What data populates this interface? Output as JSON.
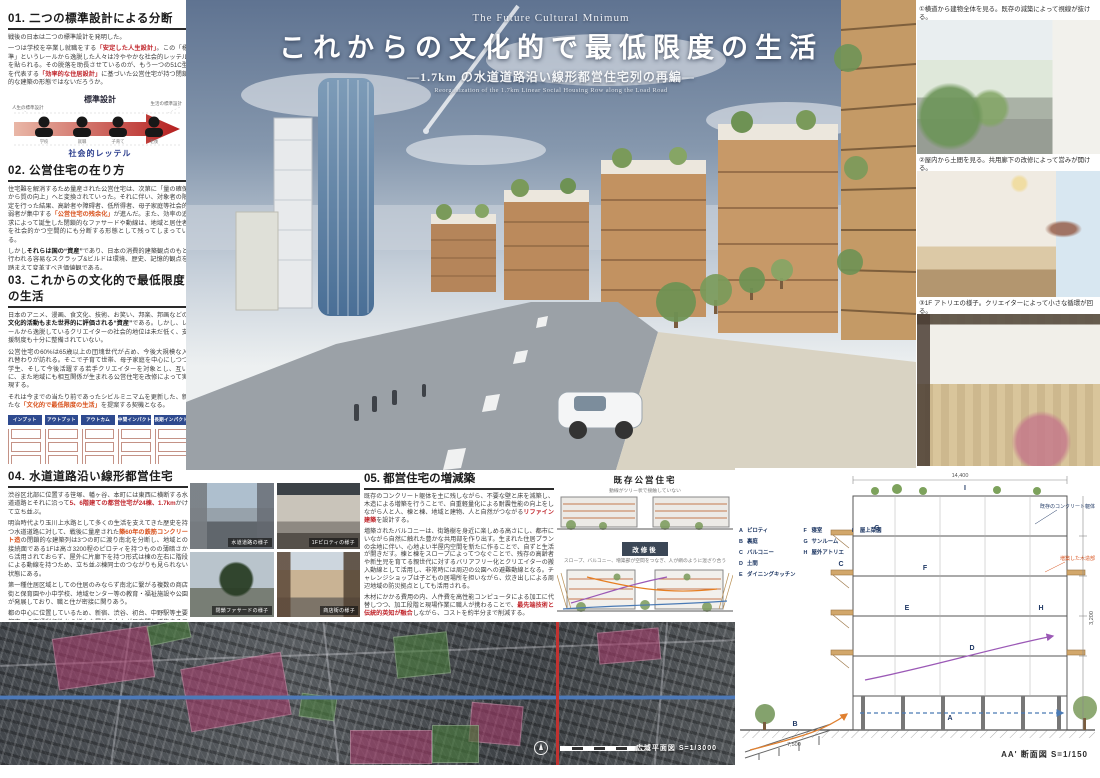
{
  "colors": {
    "accent_red": "#c1272d",
    "accent_orange": "#d9531e",
    "chip_blue": "#2e4a8f",
    "letter_navy": "#1f3864"
  },
  "sections": {
    "s1": {
      "title": "01. 二つの標準設計による分断",
      "p": [
        [
          {
            "t": "戦後の日本は二つの標準設計を発明した。"
          }
        ],
        [
          {
            "t": "一つは学校を卒業し就職をする"
          },
          {
            "t": "「安定した人生設計」",
            "c": "hl-r"
          },
          {
            "t": "。この「標準」というレールから逸脱した人々は冷ややかな社会的レッテルを貼られる。その脱落を助長させているのが、もう一つの51C型を代表する"
          },
          {
            "t": "「効率的な住居設計」",
            "c": "hl-r"
          },
          {
            "t": "に基づいた公営住宅が持つ閉鎖的な建築の形態ではないだろうか。"
          }
        ]
      ]
    },
    "s2": {
      "title": "02. 公営住宅の在り方",
      "p": [
        [
          {
            "t": "住宅難を解消するため量産された公営住宅は、次第に「量の確保から質の向上」へと変換されていった。それに伴い、対象者の限定を行った結果、高齢者や障碍者、低所得者、母子家庭等社会的弱者が集中する"
          },
          {
            "t": "「公営住宅の残余化」",
            "c": "hl-o"
          },
          {
            "t": "が進んだ。また、効率の追求によって誕生した閉鎖的なファサードや動線は、地域と居住者を社会的かつ空間的にも分断する形態として残ってしまっている。"
          }
        ],
        [
          {
            "t": "しかし"
          },
          {
            "t": "それらは国の“資産”",
            "c": "b"
          },
          {
            "t": "であり、日本の消費的建築観点のもと行われる容易なスクラップ&ビルドは環境、歴史、記憶的観点を踏まえて変革すべき価値観である。"
          }
        ]
      ]
    },
    "s3": {
      "title": "03. これからの文化的で最低限度の生活",
      "p": [
        [
          {
            "t": "日本のアニメ、漫画、食文化、技術、お笑い、邦楽、邦画などの"
          },
          {
            "t": "文化的活動もまた世界的に評価される“資産”",
            "c": "b"
          },
          {
            "t": "である。しかし、レールから逸脱しているクリエイターの社会的地位は未だ低く、支援制度も十分に整備されていない。"
          }
        ],
        [
          {
            "t": "公営住宅の60%は65歳以上の団塊世代が占め、今後大規模な入れ替わりが訪れる。そこで子育て世帯、母子家庭を中心にしつつ学生、そして今後活躍する若手クリエイターを対象とし、互いに、また地域にも相互関係が生まれる公営住宅を改修によって実現する。"
          }
        ],
        [
          {
            "t": "それは今までの当たり前であったシビルミニマムを更新した、新たな"
          },
          {
            "t": "「文化的で最低限度の生活」",
            "c": "hl-o"
          },
          {
            "t": "を提案する契機となる。"
          }
        ]
      ]
    },
    "s4": {
      "title": "04. 水道道路沿い線形都営住宅",
      "p": [
        [
          {
            "t": "渋谷区北部に位置する笹塚、幡ヶ谷、本町には東西に横断する水道道路とそれに沿って"
          },
          {
            "t": "5、6階建ての都営住宅が24棟、1.7km",
            "c": "hl-r"
          },
          {
            "t": "かけて立ち並ぶ。"
          }
        ],
        [
          {
            "t": "明治時代より玉川上水路として多くの生活を支えてきた歴史を持つ水道道路に対して、戦後に量産された"
          },
          {
            "t": "築60年の鉄筋コンクリート造",
            "c": "hl-o"
          },
          {
            "t": "の閉鎖的な建築列は3つの町に渡り南北を分断し、地域との接続面である1Fは高さ3200程のピロティを持つものの薄暗さから活用されておらず、屋外に片廊下を持つ形式は棟の左右に階段による動線を持つため、立ち並ぶ棟同士のつながりも見られない状態にある。"
          }
        ],
        [
          {
            "t": "第一種住居区域としての住居のみならず南北に繋がる複数の商店街と保育園や小中学校、地域センター等の教育・福祉施設や公園が発展しており、職と住が密接に関りあう。"
          }
        ],
        [
          {
            "t": "都の中心に位置しているため、新宿、渋谷、初台、中野駅等主要都市への交通利便性から様々な属性の人々が日夜問わず集まるエリアである。"
          }
        ]
      ]
    },
    "s5": {
      "title": "05. 都営住宅の増減築",
      "p": [
        [
          {
            "t": "既存のコンクリート躯体を主に残しながら、不要な壁と床を減築し、木造による増築を行うことで、自重軽量化による耐震性能の向上をしながら人と人、棟と棟、地域と建物、人と自然がつながる"
          },
          {
            "t": "リファイン建築",
            "c": "hl-r"
          },
          {
            "t": "を設計する。"
          }
        ],
        [
          {
            "t": "増築されたバルコニーは、街路樹を身近に楽しめる高さにし、都市にいながら自然に触れた豊かな共用部を作り出す。生まれた住居プランの余地に伴い、心地よい半屋内空間を新たに作ることで、自ずと生活が開きだす。棟と棟をスロープによってつなぐことで、残存の高齢者や新生児を育てる親世代に対するバリアフリー化とクリエイターの搬入動線として活用し、非常時には周辺の公園への避難動線となる。チャレンジショップは子どもの居場所を担いながら、炊き出しによる周辺地域の防災拠点としても活用される。"
          }
        ],
        [
          {
            "t": "木材にかかる費用の内、人件費を高性能コンピュータによる加工に代替しつつ、加工段階と現場作業に職人が携わることで、"
          },
          {
            "t": "最先端技術と伝統的英知が融合",
            "c": "hl-r"
          },
          {
            "t": "しながら、コストを約半分まで削減する。"
          }
        ]
      ]
    }
  },
  "diagram1": {
    "title": "標準設計",
    "left_note": "人生の標準設計",
    "right_note": "生活の標準設計",
    "stages": [
      "学校",
      "就職",
      "子育て",
      "老後"
    ],
    "label": "社会的レッテル",
    "net": "セーフティーネット"
  },
  "flow": {
    "chips": [
      "インプット",
      "アウトプット",
      "アウトカム",
      "中間インパクト",
      "長期インパクト"
    ]
  },
  "hero": {
    "eyebrow": "The Future Cultural Mnimum",
    "title": "これからの文化的で最低限度の生活",
    "subtitle": "—1.7km の水道道路沿い線形都営住宅列の再編—",
    "subtitle_en": "Reorganization of the 1.7km Linear Social Housing Row along the Load Road"
  },
  "right_panels": {
    "c1": "①横道から建物全体を見る。既存の減築によって視線が抜ける。",
    "c2": "②屋内から土間を見る。共用廊下の改修によって営みが開ける。",
    "c3": "③1F アトリエの様子。クリエイターによって小さな循環が回る。"
  },
  "photos": {
    "c1": "水道道路の様子",
    "c2": "1Fピロティの様子",
    "c3": "閉鎖ファサードの様子",
    "c4": "商店街の様子"
  },
  "mid": {
    "existing_title": "既存公営住宅",
    "existing_sub": "動線がツリー状で接触していない",
    "after_badge": "改修後",
    "after_sub": "スロープ、バルコニー、増築部が空間をつなぎ、人が網のように混ざり合う"
  },
  "section_drawing": {
    "legend": [
      {
        "k": "A",
        "v": "ピロティ"
      },
      {
        "k": "B",
        "v": "裏庭"
      },
      {
        "k": "C",
        "v": "バルコニー"
      },
      {
        "k": "D",
        "v": "土間"
      },
      {
        "k": "E",
        "v": "ダイニングキッチン"
      },
      {
        "k": "F",
        "v": "寝室"
      },
      {
        "k": "G",
        "v": "サンルーム"
      },
      {
        "k": "H",
        "v": "屋外アトリエ"
      },
      {
        "k": "I",
        "v": "屋上菜園"
      }
    ],
    "dim_top": "14,400",
    "dim_right": "3,200",
    "dim_bottom": "7,500",
    "note_existing": "既存のコンクリート躯体",
    "note_added": "増築した木造部",
    "caption": "AA' 断面図 S=1/150"
  },
  "map": {
    "caption": "広域平面図 S=1/3000"
  }
}
